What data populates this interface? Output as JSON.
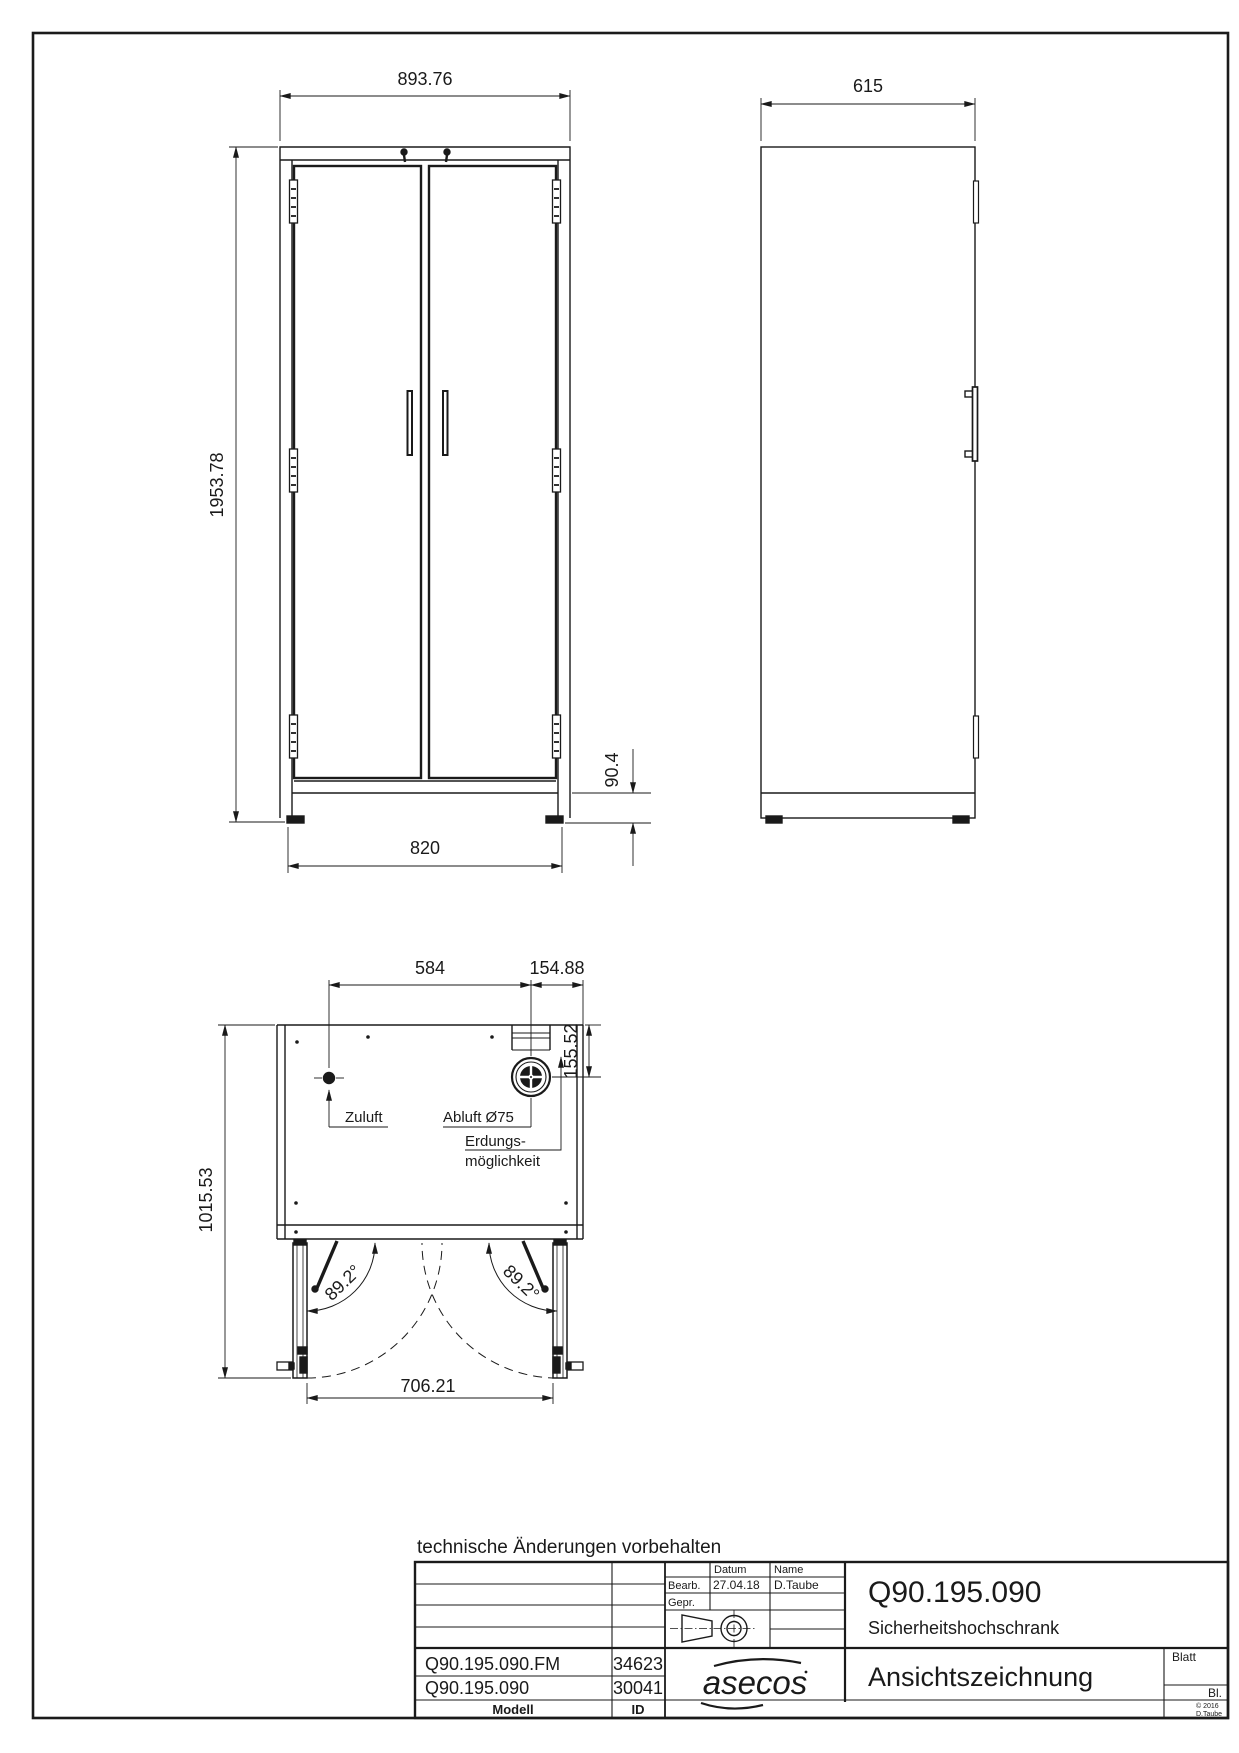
{
  "page": {
    "footnote": "technische Änderungen vorbehalten"
  },
  "front_view": {
    "width": "893.76",
    "height": "1953.78",
    "plinth_height": "90.4",
    "base_width": "820"
  },
  "side_view": {
    "depth": "615"
  },
  "top_view": {
    "zuluft_distance": "584",
    "abluft_edge_distance": "154.88",
    "abluft_rear_distance": "155.52",
    "depth_doors_open": "1015.53",
    "doors_open_width": "706.21",
    "door_angle": "89.2°",
    "zuluft_label": "Zuluft",
    "abluft_label": "Abluft Ø75",
    "erdung_line1": "Erdungs-",
    "erdung_line2": "möglichkeit"
  },
  "title_block": {
    "datum_header": "Datum",
    "name_header": "Name",
    "bearb_label": "Bearb.",
    "gepr_label": "Gepr.",
    "bearb_date": "27.04.18",
    "bearb_name": "D.Taube",
    "article_number": "Q90.195.090",
    "article_name": "Sicherheitshochschrank",
    "drawing_title": "Ansichtszeichnung",
    "blatt_label": "Blatt",
    "bl_label": "Bl.",
    "copyright_year": "© 2016",
    "copyright_name": "D.Taube",
    "logo": "asecos",
    "modell_header": "Modell",
    "id_header": "ID",
    "rows": [
      {
        "modell": "Q90.195.090.FM",
        "id": "34623"
      },
      {
        "modell": "Q90.195.090",
        "id": "30041"
      }
    ]
  },
  "colors": {
    "line": "#1a1a1a",
    "paper": "#ffffff"
  }
}
